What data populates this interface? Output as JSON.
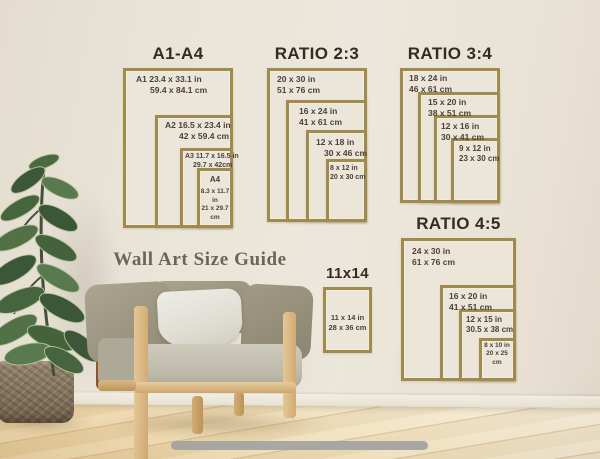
{
  "poster": {
    "guide_title": "Wall Art Size Guide",
    "sections": [
      {
        "title": "A1-A4",
        "frames": [
          {
            "line1": "A1 23.4 x 33.1 in",
            "line2": "59.4 x 84.1 cm"
          },
          {
            "line1": "A2 16.5 x 23.4 in",
            "line2": "42 x 59.4 cm"
          },
          {
            "line1": "A3 11.7 x 16.5 in",
            "line2": "29.7 x 42cm"
          },
          {
            "heading": "A4",
            "line1": "8.3 x 11.7 in",
            "line2": "21 x 29.7 cm"
          }
        ]
      },
      {
        "title": "RATIO 2:3",
        "frames": [
          {
            "line1": "20 x 30 in",
            "line2": "51 x 76 cm"
          },
          {
            "line1": "16 x 24 in",
            "line2": "41 x 61 cm"
          },
          {
            "line1": "12 x 18 in",
            "line2": "30 x 46 cm"
          },
          {
            "line1": "8 x 12 in",
            "line2": "20 x 30 cm"
          }
        ]
      },
      {
        "title": "RATIO 3:4",
        "frames": [
          {
            "line1": "18 x 24 in",
            "line2": "46 x 61 cm"
          },
          {
            "line1": "15 x 20 in",
            "line2": "38 x 51 cm"
          },
          {
            "line1": "12 x 16 in",
            "line2": "30 x 41 cm"
          },
          {
            "line1": "9 x 12 in",
            "line2": "23 x 30 cm"
          }
        ]
      },
      {
        "title": "RATIO 4:5",
        "frames": [
          {
            "line1": "24 x 30 in",
            "line2": "61 x 76 cm"
          },
          {
            "line1": "16 x 20 in",
            "line2": "41 x 51 cm"
          },
          {
            "line1": "12 x 15 in",
            "line2": "30.5 x 38 cm"
          },
          {
            "line1": "8 x 10 in",
            "line2": "20 x 25 cm"
          }
        ]
      },
      {
        "title": "11x14",
        "frames": [
          {
            "line1": "11 x 14 in",
            "line2": "28 x 36 cm"
          }
        ]
      }
    ]
  },
  "colors": {
    "frame_border": "#a08b4d",
    "section_title_text": "#342b22",
    "frame_label_text": "#4e4136",
    "guide_title_text": "#6e635a",
    "wall": "#ebe5da",
    "floor_wood": "#ecd3a3",
    "baseboard": "#efeadf",
    "bottom_bar": "#a3a3a2",
    "chair_wood": "#d2ab74",
    "chair_leather": "#a96f42",
    "cushion_olive": "#9d9681",
    "cushion_seat": "#c6c2b3",
    "pillow_white": "#e3e0d8",
    "plant_leaf_dark": "#3c5737",
    "plant_leaf_light": "#6b8a5e",
    "planter_basket": "#82715c"
  }
}
